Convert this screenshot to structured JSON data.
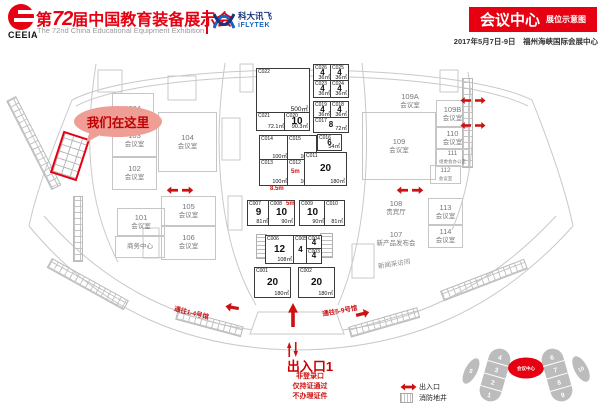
{
  "colors": {
    "brand_red": "#e60012",
    "map_red": "#cc1111",
    "iflytek_blue": "#1565c0",
    "structure_gray": "#c6c6c6"
  },
  "header": {
    "org": "CEEIA",
    "title_prefix": "第",
    "title_num": "72",
    "title_suffix": "届中国教育装备展示会",
    "subtitle_en": "The 72nd China Educational Equipment Exhibition",
    "sponsor_cn": "科大讯飞",
    "sponsor_en": "iFLYTEK",
    "banner_title": "会议中心",
    "banner_subtitle": "展位示意图",
    "date_venue": "2017年5月7日-9日　福州海峡国际会展中心"
  },
  "map": {
    "callout": "我们在这里",
    "rooms": [
      {
        "num": "103A",
        "name": ""
      },
      {
        "num": "103",
        "name": "会议室"
      },
      {
        "num": "102",
        "name": "会议室"
      },
      {
        "num": "101",
        "name": "会议室"
      },
      {
        "num": "",
        "name": "商务中心"
      },
      {
        "num": "104",
        "name": "会议室"
      },
      {
        "num": "105",
        "name": "会议室"
      },
      {
        "num": "106",
        "name": "会议室"
      },
      {
        "num": "109A",
        "name": "会议室"
      },
      {
        "num": "109",
        "name": "会议室"
      },
      {
        "num": "109B",
        "name": "会议室"
      },
      {
        "num": "110",
        "name": "会议室"
      },
      {
        "num": "111",
        "name": "组委会办公室"
      },
      {
        "num": "112",
        "name": "会议室"
      },
      {
        "num": "113",
        "name": "会议室"
      },
      {
        "num": "114",
        "name": "会议室"
      },
      {
        "num": "108",
        "name": "贵宾厅"
      },
      {
        "num": "107",
        "name": "新产品发布会"
      },
      {
        "num": "",
        "name": "新闻采访间"
      }
    ],
    "booths": [
      {
        "id": "C022",
        "count": "",
        "area": "500㎡"
      },
      {
        "id": "C021",
        "count": "",
        "area": "72.1㎡"
      },
      {
        "id": "C020",
        "count": "10",
        "area": "90.3㎡"
      },
      {
        "id": "C026",
        "count": "4",
        "area": "36㎡"
      },
      {
        "id": "C025",
        "count": "4",
        "area": "36㎡"
      },
      {
        "id": "C023",
        "count": "4",
        "area": "36㎡"
      },
      {
        "id": "C024",
        "count": "4",
        "area": "36㎡"
      },
      {
        "id": "C019",
        "count": "4",
        "area": "36㎡"
      },
      {
        "id": "C018",
        "count": "4",
        "area": "36㎡"
      },
      {
        "id": "C017",
        "count": "8",
        "area": "72㎡"
      },
      {
        "id": "C016",
        "count": "6",
        "area": "54㎡"
      },
      {
        "id": "C014",
        "count": "",
        "area": "100㎡"
      },
      {
        "id": "C015",
        "count": "",
        "area": "100㎡"
      },
      {
        "id": "C013",
        "count": "",
        "area": "100㎡"
      },
      {
        "id": "C012",
        "count": "",
        "area": "100㎡"
      },
      {
        "id": "C011",
        "count": "20",
        "area": "180㎡"
      },
      {
        "id": "C007",
        "count": "9",
        "area": "81㎡"
      },
      {
        "id": "C008",
        "count": "10",
        "area": "90㎡"
      },
      {
        "id": "C009",
        "count": "10",
        "area": "90㎡"
      },
      {
        "id": "C010",
        "count": "",
        "area": "81㎡"
      },
      {
        "id": "C006",
        "count": "12",
        "area": "108㎡"
      },
      {
        "id": "C005",
        "count": "4",
        "area": ""
      },
      {
        "id": "C004",
        "count": "4",
        "area": ""
      },
      {
        "id": "C003",
        "count": "4",
        "area": ""
      },
      {
        "id": "C001",
        "count": "20",
        "area": "180㎡"
      },
      {
        "id": "C002",
        "count": "20",
        "area": "180㎡"
      }
    ],
    "dims": [
      "8.5m",
      "5m",
      "5m"
    ],
    "corridors": {
      "left": "通往1-4号馆",
      "right": "通往5-9号馆"
    },
    "entrance": {
      "title": "出入口1",
      "notes": [
        "非登录口",
        "仅持证通过",
        "不办理证件"
      ]
    },
    "legend": {
      "entrance": "出入口",
      "firewell": "消防地井"
    },
    "minimap": {
      "center": "会议中心",
      "left_outer": "5",
      "right_outer": "10",
      "left_halls": [
        "4",
        "3",
        "2",
        "1"
      ],
      "right_halls": [
        "6",
        "7",
        "8",
        "9"
      ]
    }
  }
}
